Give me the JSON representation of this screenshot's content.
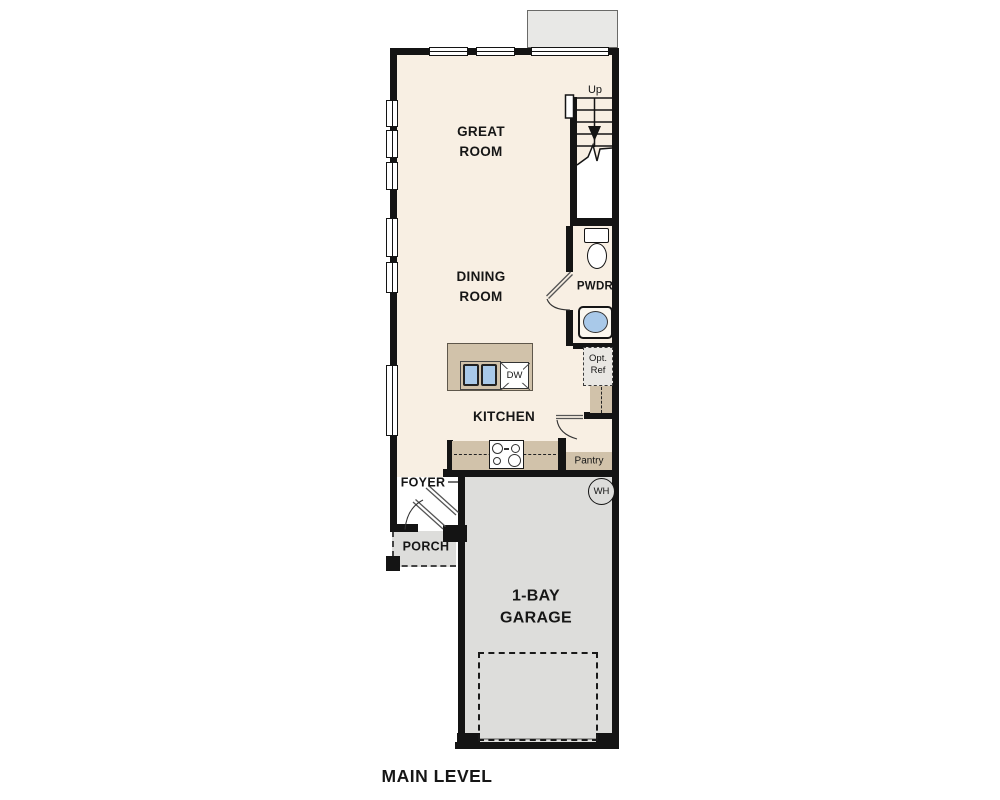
{
  "plan": {
    "title": "MAIN LEVEL",
    "rooms": {
      "great_room": "GREAT\nROOM",
      "dining_room": "DINING\nROOM",
      "kitchen": "KITCHEN",
      "foyer": "FOYER",
      "porch": "PORCH",
      "garage": "1-BAY\nGARAGE",
      "powder": "PWDR",
      "pantry": "Pantry"
    },
    "annotations": {
      "stairs_up": "Up",
      "dishwasher": "DW",
      "water_heater": "WH",
      "optional_refrigerator": "Opt.\nRef"
    },
    "colors": {
      "wall": "#141414",
      "interior_cream": "#f8efe3",
      "counter_tan": "#d1c2aa",
      "garage_gray": "#dddddb",
      "patio_gray": "#e8e8e6",
      "sink_blue": "#a9c9e9"
    }
  }
}
